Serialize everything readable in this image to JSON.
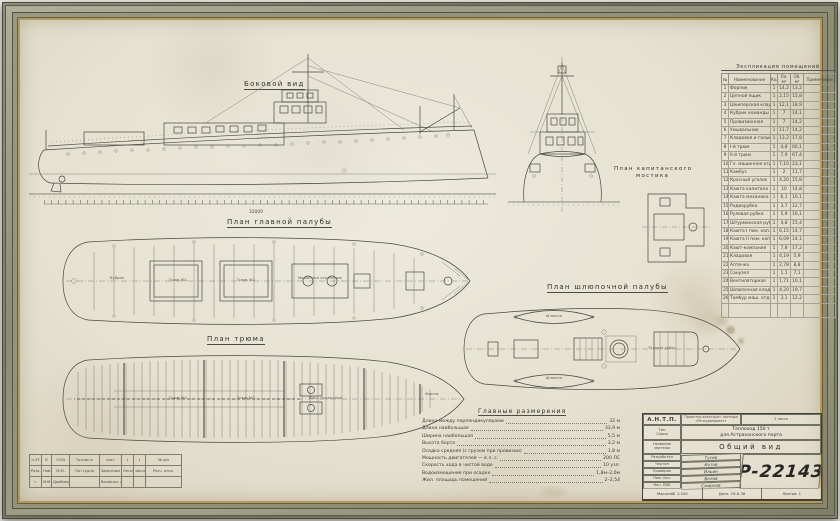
{
  "labels": {
    "side_view": "Боковой вид",
    "main_deck": "План главной палубы",
    "hold": "План трюма",
    "boat_deck": "План шлюпочной палубы",
    "bridge_line1": "План капитанского",
    "bridge_line2": "мостика"
  },
  "side_view": {
    "length_dim": "32000"
  },
  "explication": {
    "title": "Экспликация помещений",
    "headers": [
      "№",
      "Наименование",
      "Кол",
      "Пл. м²",
      "Об. м³",
      "Примечание"
    ],
    "rows": [
      [
        "1",
        "Форпик",
        "1",
        "14,2",
        "13,2",
        ""
      ],
      [
        "2",
        "Цепной ящик",
        "1",
        "2,15",
        "15,8",
        ""
      ],
      [
        "3",
        "Шкиперская кладов.",
        "1",
        "12,1",
        "18,9",
        ""
      ],
      [
        "4",
        "Кубрик команды",
        "1",
        "7",
        "14,1",
        ""
      ],
      [
        "5",
        "Провизионная",
        "1",
        "7",
        "14,2",
        ""
      ],
      [
        "6",
        "Умывальник",
        "1",
        "11,7",
        "14,2",
        ""
      ],
      [
        "7",
        "Кладовая и гальюн",
        "1",
        "13,2",
        "17,8",
        ""
      ],
      [
        "8",
        "I-й трюм",
        "1",
        "4,8",
        "60,1",
        ""
      ],
      [
        "9",
        "II-й трюм",
        "1",
        "7,9",
        "67,4",
        ""
      ],
      [
        "10",
        "Гл. машинное отд.",
        "1",
        "7,10",
        "23,1",
        ""
      ],
      [
        "11",
        "Камбуз",
        "1",
        "2",
        "11,7",
        ""
      ],
      [
        "12",
        "Красный уголок",
        "1",
        "4,20",
        "15,8",
        ""
      ],
      [
        "13",
        "Каюта капитана",
        "1",
        "10",
        "14,8",
        ""
      ],
      [
        "14",
        "Каюта механика",
        "1",
        "6,1",
        "16,1",
        ""
      ],
      [
        "15",
        "Радиорубка",
        "1",
        "3,7",
        "12,7",
        ""
      ],
      [
        "16",
        "Рулевая рубка",
        "1",
        "5,9",
        "16,1",
        ""
      ],
      [
        "17",
        "Штурманская рубка",
        "1",
        "4,8",
        "15,4",
        ""
      ],
      [
        "18",
        "Каюта I пом. кап.",
        "1",
        "6,15",
        "14,7",
        ""
      ],
      [
        "19",
        "Каюта II пом. кап.",
        "1",
        "6,09",
        "14,1",
        ""
      ],
      [
        "20",
        "Кают-компания",
        "1",
        "7,8",
        "17,2",
        ""
      ],
      [
        "21",
        "Кладовая",
        "1",
        "4,19",
        "5,9",
        ""
      ],
      [
        "22",
        "Аптечка",
        "1",
        "2,78",
        "8,8",
        ""
      ],
      [
        "23",
        "Санузел",
        "1",
        "1,1",
        "7,1",
        ""
      ],
      [
        "24",
        "Вентиляторная",
        "1",
        "1,71",
        "10,1",
        ""
      ],
      [
        "25",
        "Шлюпочная кладов.",
        "1",
        "4,20",
        "19,7",
        ""
      ],
      [
        "26",
        "Тамбур маш. отд.",
        "1",
        "3,1",
        "12,2",
        ""
      ]
    ]
  },
  "dimensions": {
    "title": "Главные размерения",
    "lines": [
      {
        "label": "Длина между перпендикулярами",
        "value": "32 м"
      },
      {
        "label": "Длина наибольшая",
        "value": "33,9 м"
      },
      {
        "label": "Ширина наибольшая",
        "value": "5,5 м"
      },
      {
        "label": "Высота борта",
        "value": "3,2 м"
      },
      {
        "label": "Осадка средняя (с грузом при провизии)",
        "value": "1,8 м"
      },
      {
        "label": "Мощность двигателей — в л. с.",
        "value": "200 ЛС"
      },
      {
        "label": "Скорость хода в чистой воде",
        "value": "10 узл."
      },
      {
        "label": "Водоизмещение при осадке",
        "value": "1,8м–2,0м"
      },
      {
        "label": "Жил. площадь помещений",
        "value": "2–2,54"
      }
    ]
  },
  "title_block": {
    "org": "А.Н.Т.П.",
    "org_sub1": "Проектно-конструкт. контора",
    "org_sub2": "«Речсудопроект»",
    "org_right": "2 листа",
    "type_label1": "Тип",
    "type_label2": "Серия",
    "type_value1": "Теплоход 150 т",
    "type_value2": "для Астраханского порта",
    "name_label1": "Название",
    "name_label2": "чертежа",
    "name_value": "Общий вид",
    "sign_rows": [
      {
        "label": "Разработал",
        "value": "Гусев"
      },
      {
        "label": "Чертил",
        "value": "Котов"
      },
      {
        "label": "Проверил",
        "value": "Ильин"
      },
      {
        "label": "Пом. нач.",
        "value": "Белов"
      },
      {
        "label": "Нач. ПКБ",
        "value": "Смирнов"
      }
    ],
    "drawing_number": "Р-22143",
    "footer": [
      {
        "label": "Масштаб",
        "value": "1:100"
      },
      {
        "label": "Дата",
        "value": "19.X.38"
      },
      {
        "label": "Листов",
        "value": "1"
      }
    ]
  },
  "revision": {
    "rows": [
      [
        "п.33",
        "Б",
        "1934",
        "Точность",
        "лист",
        "1",
        "1",
        "№ а/м"
      ],
      [
        "Разр.",
        "Нов.",
        "М.М.",
        "Тип судна",
        "Заречным",
        "Ом.отд.",
        "зам.роли",
        "Расч. отпр."
      ],
      [
        "г",
        "М.М.",
        "Дообмер",
        "",
        "Возможн. копий",
        "",
        "",
        ""
      ]
    ]
  },
  "annotations": {
    "a1": "Кубрик",
    "a2": "Трюм №1",
    "a3": "Трюм №2",
    "a4": "Машинное отделение",
    "a5": "Трюм №1",
    "a6": "Трюм №2",
    "a7": "Маш. отделение",
    "a8": "Форпик",
    "a9": "Шлюпка",
    "a10": "Шлюпка",
    "a11": "Рулевая рубка"
  }
}
